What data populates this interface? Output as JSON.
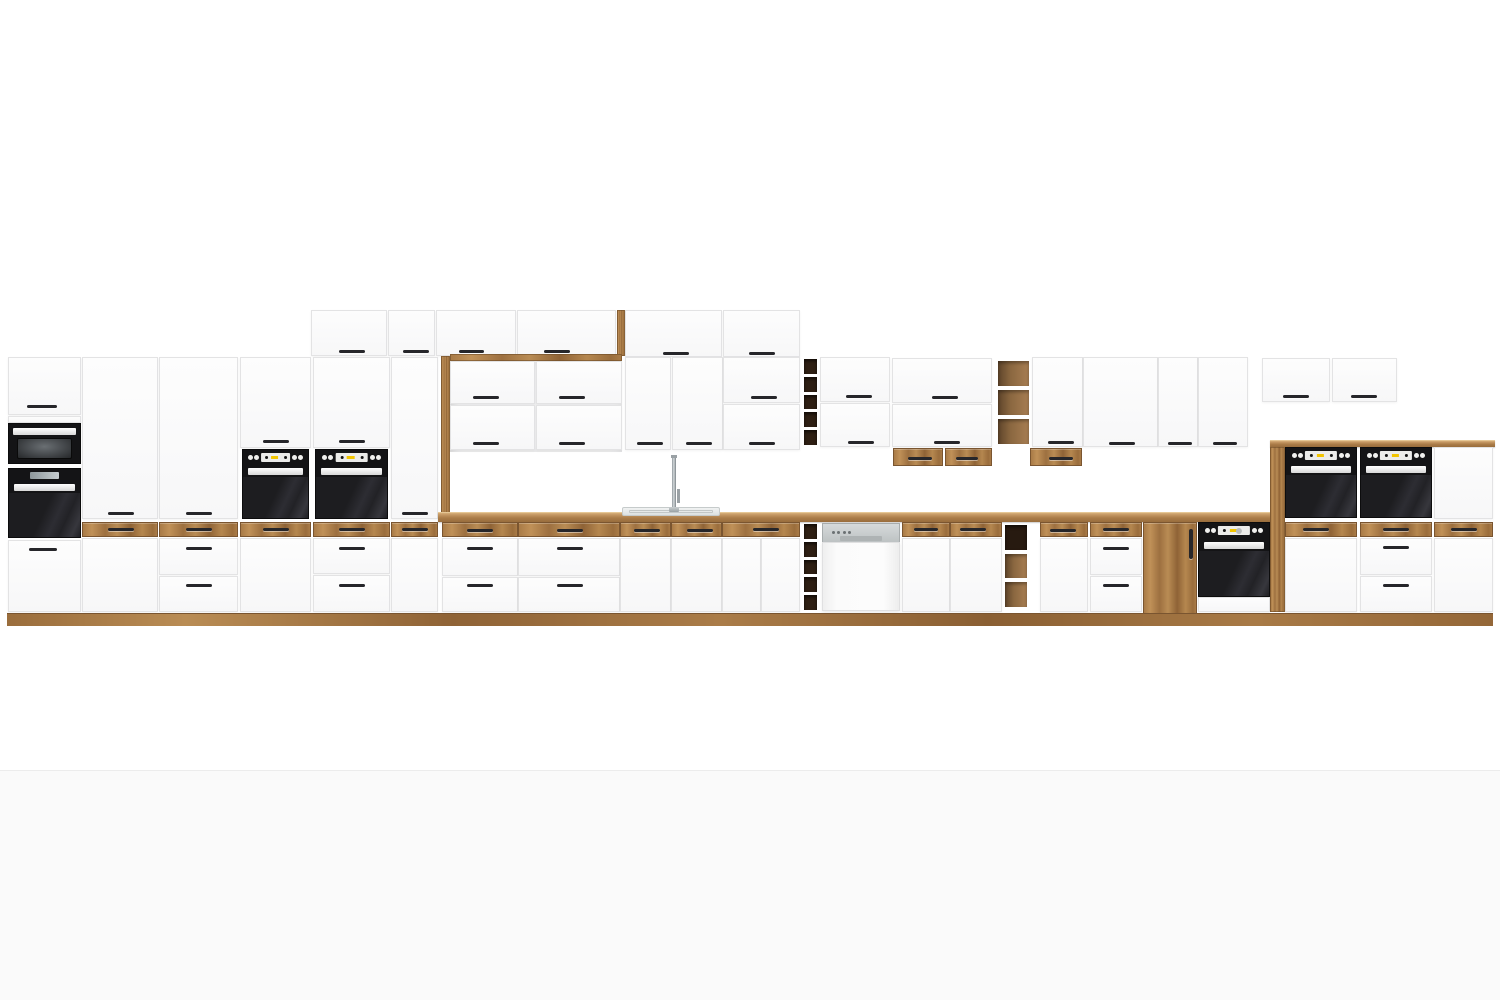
{
  "page": {
    "width": 1500,
    "height": 1000,
    "background": "#ffffff",
    "floor_band": {
      "y": 770,
      "color": "#fafafa",
      "divider_color": "#ececec"
    }
  },
  "palette": {
    "wood": "#ab7d49",
    "wood_light": "#c49a63",
    "wood_dark": "#8c6337",
    "counter_top": "#d6ae79",
    "front_white": "#fcfcfc",
    "front_edge": "#e3e3e4",
    "handle": "#26262a",
    "appliance_black": "#141416",
    "oven_door": "#26262a",
    "display_yellow": "#f2c500",
    "steel": "#c7cbcc",
    "cubby_dark": "#2e1f13",
    "shelf_wood": "#8a6740",
    "sink_steel": "#e7eaea"
  },
  "modules": [
    {
      "n": "recess-back-panel",
      "t": "recess",
      "x": 450,
      "y": 356,
      "w": 172,
      "h": 96
    },
    {
      "n": "wall-top-door-1",
      "t": "door",
      "x": 311,
      "y": 310,
      "w": 76,
      "h": 46,
      "hd": [
        [
          338,
          349,
          26
        ]
      ]
    },
    {
      "n": "wall-top-door-2",
      "t": "door",
      "x": 388,
      "y": 310,
      "w": 47,
      "h": 46,
      "hd": [
        [
          402,
          349,
          26
        ]
      ]
    },
    {
      "n": "wall-top-door-3",
      "t": "door",
      "x": 436,
      "y": 310,
      "w": 80,
      "h": 46,
      "hd": [
        [
          458,
          349,
          25
        ]
      ]
    },
    {
      "n": "wall-top-door-4",
      "t": "door",
      "x": 517,
      "y": 310,
      "w": 99,
      "h": 46,
      "hd": [
        [
          543,
          349,
          26
        ]
      ]
    },
    {
      "n": "wall-top-end-panel",
      "t": "woodstrip",
      "x": 617,
      "y": 310,
      "w": 8,
      "h": 46
    },
    {
      "n": "wall-top-door-5",
      "t": "door",
      "x": 625,
      "y": 310,
      "w": 97,
      "h": 47,
      "hd": [
        [
          662,
          351,
          26
        ]
      ]
    },
    {
      "n": "wall-top-door-6",
      "t": "door",
      "x": 723,
      "y": 310,
      "w": 77,
      "h": 47,
      "hd": [
        [
          748,
          351,
          26
        ]
      ]
    },
    {
      "n": "tall1-top-door",
      "t": "door",
      "x": 8,
      "y": 357,
      "w": 73,
      "h": 58,
      "hd": [
        [
          26,
          404,
          30
        ]
      ]
    },
    {
      "n": "tall1-filler",
      "t": "door",
      "x": 8,
      "y": 416,
      "w": 73,
      "h": 7
    },
    {
      "n": "tall1-microwave",
      "t": "micro",
      "x": 8,
      "y": 423,
      "w": 73,
      "h": 41
    },
    {
      "n": "tall1-compact-oven",
      "t": "compact",
      "x": 8,
      "y": 468,
      "w": 73,
      "h": 70
    },
    {
      "n": "tall1-drawer",
      "t": "door",
      "x": 8,
      "y": 540,
      "w": 73,
      "h": 72,
      "hd": [
        [
          28,
          547,
          28
        ]
      ]
    },
    {
      "n": "tall2-door-upper",
      "t": "door",
      "x": 82,
      "y": 357,
      "w": 76,
      "h": 162,
      "hd": [
        [
          107,
          511,
          26
        ]
      ]
    },
    {
      "n": "tall2-wood-drawer",
      "t": "woodfront",
      "x": 82,
      "y": 522,
      "w": 76,
      "h": 15,
      "hd": [
        [
          107,
          527,
          26
        ]
      ]
    },
    {
      "n": "tall2-door-lower",
      "t": "door",
      "x": 82,
      "y": 538,
      "w": 76,
      "h": 74
    },
    {
      "n": "tall3-door-upper",
      "t": "door",
      "x": 159,
      "y": 357,
      "w": 79,
      "h": 162,
      "hd": [
        [
          185,
          511,
          26
        ]
      ]
    },
    {
      "n": "tall3-wood-drawer",
      "t": "woodfront",
      "x": 159,
      "y": 522,
      "w": 79,
      "h": 15,
      "hd": [
        [
          185,
          527,
          26
        ]
      ]
    },
    {
      "n": "tall3-drawer-1",
      "t": "door",
      "x": 159,
      "y": 538,
      "w": 79,
      "h": 37,
      "hd": [
        [
          185,
          546,
          26
        ]
      ]
    },
    {
      "n": "tall3-drawer-2",
      "t": "door",
      "x": 159,
      "y": 576,
      "w": 79,
      "h": 36,
      "hd": [
        [
          185,
          583,
          26
        ]
      ]
    },
    {
      "n": "ovencol1-door",
      "t": "door",
      "x": 240,
      "y": 357,
      "w": 71,
      "h": 91,
      "hd": [
        [
          262,
          439,
          26
        ]
      ]
    },
    {
      "n": "ovencol1-oven",
      "t": "oven",
      "x": 242,
      "y": 449,
      "w": 67,
      "h": 70
    },
    {
      "n": "ovencol1-wood-drawer",
      "t": "woodfront",
      "x": 240,
      "y": 522,
      "w": 71,
      "h": 15,
      "hd": [
        [
          262,
          527,
          26
        ]
      ]
    },
    {
      "n": "ovencol1-door-lower",
      "t": "door",
      "x": 240,
      "y": 538,
      "w": 71,
      "h": 74
    },
    {
      "n": "ovencol2-door",
      "t": "door",
      "x": 313,
      "y": 357,
      "w": 77,
      "h": 91,
      "hd": [
        [
          338,
          439,
          26
        ]
      ]
    },
    {
      "n": "ovencol2-oven",
      "t": "oven",
      "x": 315,
      "y": 449,
      "w": 73,
      "h": 70
    },
    {
      "n": "ovencol2-wood-drawer",
      "t": "woodfront",
      "x": 313,
      "y": 522,
      "w": 77,
      "h": 15,
      "hd": [
        [
          338,
          527,
          26
        ]
      ]
    },
    {
      "n": "ovencol2-drawer-1",
      "t": "door",
      "x": 313,
      "y": 538,
      "w": 77,
      "h": 36,
      "hd": [
        [
          338,
          546,
          26
        ]
      ]
    },
    {
      "n": "ovencol2-drawer-2",
      "t": "door",
      "x": 313,
      "y": 575,
      "w": 77,
      "h": 37,
      "hd": [
        [
          338,
          583,
          26
        ]
      ]
    },
    {
      "n": "tall4-door",
      "t": "door",
      "x": 391,
      "y": 357,
      "w": 47,
      "h": 162,
      "hd": [
        [
          401,
          511,
          26
        ]
      ]
    },
    {
      "n": "tall4-wood-drawer",
      "t": "woodfront",
      "x": 391,
      "y": 522,
      "w": 47,
      "h": 15,
      "hd": [
        [
          401,
          527,
          26
        ]
      ]
    },
    {
      "n": "tall4-door-lower",
      "t": "door",
      "x": 391,
      "y": 538,
      "w": 47,
      "h": 74
    },
    {
      "n": "recess-frame-left",
      "t": "woodstrip",
      "x": 441,
      "y": 356,
      "w": 9,
      "h": 160
    },
    {
      "n": "recess-frame-top",
      "t": "woodstrip",
      "x": 450,
      "y": 354,
      "w": 172,
      "h": 7
    },
    {
      "n": "recess-flap-1",
      "t": "door",
      "x": 450,
      "y": 361,
      "w": 85,
      "h": 43,
      "hd": [
        [
          472,
          395,
          26
        ]
      ]
    },
    {
      "n": "recess-flap-2",
      "t": "door",
      "x": 536,
      "y": 361,
      "w": 86,
      "h": 43,
      "hd": [
        [
          558,
          395,
          26
        ]
      ]
    },
    {
      "n": "recess-flap-3",
      "t": "door",
      "x": 450,
      "y": 405,
      "w": 85,
      "h": 45,
      "hd": [
        [
          472,
          441,
          26
        ]
      ]
    },
    {
      "n": "recess-flap-4",
      "t": "door",
      "x": 536,
      "y": 405,
      "w": 86,
      "h": 45,
      "hd": [
        [
          558,
          441,
          26
        ]
      ]
    },
    {
      "n": "wall-door-1",
      "t": "door",
      "x": 625,
      "y": 357,
      "w": 46,
      "h": 93,
      "hd": [
        [
          636,
          441,
          26
        ]
      ]
    },
    {
      "n": "wall-door-2",
      "t": "door",
      "x": 672,
      "y": 357,
      "w": 51,
      "h": 93,
      "hd": [
        [
          685,
          441,
          26
        ]
      ]
    },
    {
      "n": "wall-flap-1",
      "t": "door",
      "x": 723,
      "y": 357,
      "w": 77,
      "h": 46,
      "hd": [
        [
          750,
          395,
          26
        ]
      ]
    },
    {
      "n": "wall-flap-2",
      "t": "door",
      "x": 723,
      "y": 404,
      "w": 77,
      "h": 46,
      "hd": [
        [
          748,
          441,
          26
        ]
      ]
    },
    {
      "n": "wall-wine-rack",
      "t": "wine",
      "x": 802,
      "y": 357,
      "w": 17,
      "h": 90,
      "cells": 5
    },
    {
      "n": "wall-flap-3",
      "t": "door",
      "x": 820,
      "y": 357,
      "w": 70,
      "h": 45,
      "hd": [
        [
          845,
          394,
          26
        ]
      ]
    },
    {
      "n": "wall-flap-4",
      "t": "door",
      "x": 820,
      "y": 403,
      "w": 70,
      "h": 44,
      "hd": [
        [
          847,
          440,
          26
        ]
      ]
    },
    {
      "n": "wall-flap-5",
      "t": "door",
      "x": 892,
      "y": 358,
      "w": 100,
      "h": 45,
      "hd": [
        [
          931,
          395,
          26
        ]
      ]
    },
    {
      "n": "wall-flap-6",
      "t": "door",
      "x": 892,
      "y": 404,
      "w": 100,
      "h": 43,
      "hd": [
        [
          933,
          440,
          26
        ]
      ]
    },
    {
      "n": "wall-wood-drawer-1",
      "t": "woodfront",
      "x": 893,
      "y": 448,
      "w": 50,
      "h": 18,
      "hd": [
        [
          907,
          456,
          24
        ]
      ]
    },
    {
      "n": "wall-wood-drawer-2",
      "t": "woodfront",
      "x": 945,
      "y": 448,
      "w": 47,
      "h": 18,
      "hd": [
        [
          955,
          456,
          22
        ]
      ]
    },
    {
      "n": "wall-open-shelf",
      "t": "shelf",
      "x": 995,
      "y": 358,
      "w": 37,
      "h": 89,
      "cells": [
        "mid",
        "mid",
        "mid"
      ]
    },
    {
      "n": "wall-door-3",
      "t": "door",
      "x": 1032,
      "y": 357,
      "w": 51,
      "h": 90,
      "hd": [
        [
          1047,
          440,
          26
        ]
      ]
    },
    {
      "n": "wall-wood-drawer-3",
      "t": "woodfront",
      "x": 1030,
      "y": 448,
      "w": 52,
      "h": 18,
      "hd": [
        [
          1048,
          456,
          24
        ]
      ]
    },
    {
      "n": "wall-door-4",
      "t": "door",
      "x": 1083,
      "y": 357,
      "w": 75,
      "h": 90,
      "hd": [
        [
          1108,
          441,
          26
        ]
      ]
    },
    {
      "n": "wall-door-5",
      "t": "door",
      "x": 1158,
      "y": 357,
      "w": 40,
      "h": 90,
      "hd": [
        [
          1167,
          441,
          24
        ]
      ]
    },
    {
      "n": "wall-door-6",
      "t": "door",
      "x": 1198,
      "y": 357,
      "w": 50,
      "h": 90,
      "hd": [
        [
          1212,
          441,
          24
        ]
      ]
    },
    {
      "n": "overoven-flap-1",
      "t": "door",
      "x": 1262,
      "y": 358,
      "w": 68,
      "h": 44,
      "hd": [
        [
          1282,
          394,
          26
        ]
      ]
    },
    {
      "n": "overoven-flap-2",
      "t": "door",
      "x": 1332,
      "y": 358,
      "w": 65,
      "h": 44,
      "hd": [
        [
          1350,
          394,
          26
        ]
      ]
    },
    {
      "n": "countertop",
      "t": "counter",
      "x": 438,
      "y": 512,
      "w": 832,
      "h": 10
    },
    {
      "n": "sink-basin",
      "t": "sink",
      "x": 622,
      "y": 507,
      "w": 98,
      "h": 9
    },
    {
      "n": "faucet",
      "t": "faucet",
      "x": 668,
      "y": 455,
      "w": 18,
      "h": 57
    },
    {
      "n": "base1-wood-drawer",
      "t": "woodfront",
      "x": 442,
      "y": 522,
      "w": 76,
      "h": 15,
      "hd": [
        [
          466,
          528,
          26
        ]
      ]
    },
    {
      "n": "base1-drawer-1",
      "t": "door",
      "x": 442,
      "y": 538,
      "w": 76,
      "h": 38,
      "hd": [
        [
          466,
          546,
          26
        ]
      ]
    },
    {
      "n": "base1-drawer-2",
      "t": "door",
      "x": 442,
      "y": 577,
      "w": 76,
      "h": 35,
      "hd": [
        [
          466,
          583,
          26
        ]
      ]
    },
    {
      "n": "base2-wood-drawer",
      "t": "woodfront",
      "x": 518,
      "y": 522,
      "w": 102,
      "h": 15,
      "hd": [
        [
          556,
          528,
          26
        ]
      ]
    },
    {
      "n": "base2-drawer-1",
      "t": "door",
      "x": 518,
      "y": 538,
      "w": 102,
      "h": 38,
      "hd": [
        [
          556,
          546,
          26
        ]
      ]
    },
    {
      "n": "base2-drawer-2",
      "t": "door",
      "x": 518,
      "y": 577,
      "w": 102,
      "h": 35,
      "hd": [
        [
          556,
          583,
          26
        ]
      ]
    },
    {
      "n": "sinkbase-wood-drawer-1",
      "t": "woodfront",
      "x": 620,
      "y": 522,
      "w": 51,
      "h": 15,
      "hd": [
        [
          633,
          528,
          26
        ]
      ]
    },
    {
      "n": "sinkbase-wood-drawer-2",
      "t": "woodfront",
      "x": 671,
      "y": 522,
      "w": 51,
      "h": 15,
      "hd": [
        [
          686,
          528,
          26
        ]
      ]
    },
    {
      "n": "sinkbase-door-1",
      "t": "door",
      "x": 620,
      "y": 538,
      "w": 51,
      "h": 74
    },
    {
      "n": "sinkbase-door-2",
      "t": "door",
      "x": 671,
      "y": 538,
      "w": 51,
      "h": 74
    },
    {
      "n": "base3-wood-drawer",
      "t": "woodfront",
      "x": 722,
      "y": 522,
      "w": 78,
      "h": 15,
      "hd": [
        [
          752,
          527,
          26
        ]
      ]
    },
    {
      "n": "base3-door-1",
      "t": "door",
      "x": 722,
      "y": 538,
      "w": 39,
      "h": 74
    },
    {
      "n": "base3-door-2",
      "t": "door",
      "x": 761,
      "y": 538,
      "w": 39,
      "h": 74
    },
    {
      "n": "base-wine-rack",
      "t": "wine",
      "x": 802,
      "y": 522,
      "w": 17,
      "h": 90,
      "cells": 5
    },
    {
      "n": "dishwasher",
      "t": "dw",
      "x": 822,
      "y": 523,
      "w": 78,
      "h": 88
    },
    {
      "n": "base4-wood-drawer",
      "t": "woodfront",
      "x": 902,
      "y": 522,
      "w": 48,
      "h": 15,
      "hd": [
        [
          913,
          527,
          24
        ]
      ]
    },
    {
      "n": "base4-door",
      "t": "door",
      "x": 902,
      "y": 538,
      "w": 48,
      "h": 74
    },
    {
      "n": "base5-wood-drawer",
      "t": "woodfront",
      "x": 950,
      "y": 522,
      "w": 52,
      "h": 15,
      "hd": [
        [
          959,
          527,
          26
        ]
      ]
    },
    {
      "n": "base5-door",
      "t": "door",
      "x": 950,
      "y": 538,
      "w": 52,
      "h": 74
    },
    {
      "n": "base-open-shelf",
      "t": "shelf",
      "x": 1002,
      "y": 522,
      "w": 28,
      "h": 88,
      "cells": [
        "dark",
        "mid",
        "mid"
      ]
    },
    {
      "n": "base6-wood-drawer",
      "t": "woodfront",
      "x": 1040,
      "y": 522,
      "w": 48,
      "h": 15,
      "hd": [
        [
          1049,
          528,
          26
        ]
      ]
    },
    {
      "n": "base6-door",
      "t": "door",
      "x": 1040,
      "y": 538,
      "w": 48,
      "h": 74
    },
    {
      "n": "base7-wood-drawer",
      "t": "woodfront",
      "x": 1090,
      "y": 522,
      "w": 52,
      "h": 15,
      "hd": [
        [
          1102,
          527,
          26
        ]
      ]
    },
    {
      "n": "base7-drawer-1",
      "t": "door",
      "x": 1090,
      "y": 538,
      "w": 52,
      "h": 37,
      "hd": [
        [
          1102,
          546,
          26
        ]
      ]
    },
    {
      "n": "base7-drawer-2",
      "t": "door",
      "x": 1090,
      "y": 576,
      "w": 52,
      "h": 36,
      "hd": [
        [
          1102,
          583,
          26
        ]
      ]
    },
    {
      "n": "base-wood-door",
      "t": "woodfront",
      "x": 1143,
      "y": 522,
      "w": 54,
      "h": 95,
      "hv": [
        1188,
        528,
        30
      ]
    },
    {
      "n": "base-oven",
      "t": "baseoven",
      "x": 1198,
      "y": 522,
      "w": 72,
      "h": 75
    },
    {
      "n": "base-oven-bottom-panel",
      "t": "door",
      "x": 1198,
      "y": 597,
      "w": 72,
      "h": 15
    },
    {
      "n": "housing-countertop",
      "t": "counter",
      "x": 1270,
      "y": 440,
      "w": 225,
      "h": 7
    },
    {
      "n": "housing-left-panel",
      "t": "woodstrip",
      "x": 1270,
      "y": 447,
      "w": 15,
      "h": 165
    },
    {
      "n": "housing-oven-1",
      "t": "oven",
      "x": 1285,
      "y": 447,
      "w": 72,
      "h": 71
    },
    {
      "n": "housing-oven-2",
      "t": "oven",
      "x": 1360,
      "y": 447,
      "w": 72,
      "h": 71
    },
    {
      "n": "housing-upper-panel",
      "t": "door",
      "x": 1434,
      "y": 447,
      "w": 59,
      "h": 72
    },
    {
      "n": "housing-wood-drawer-1",
      "t": "woodfront",
      "x": 1285,
      "y": 522,
      "w": 72,
      "h": 15,
      "hd": [
        [
          1302,
          527,
          26
        ]
      ]
    },
    {
      "n": "housing-wood-drawer-2",
      "t": "woodfront",
      "x": 1360,
      "y": 522,
      "w": 72,
      "h": 15,
      "hd": [
        [
          1382,
          527,
          26
        ]
      ]
    },
    {
      "n": "housing-wood-drawer-3",
      "t": "woodfront",
      "x": 1434,
      "y": 522,
      "w": 59,
      "h": 15,
      "hd": [
        [
          1450,
          527,
          26
        ]
      ]
    },
    {
      "n": "housing-door-1",
      "t": "door",
      "x": 1285,
      "y": 538,
      "w": 72,
      "h": 74
    },
    {
      "n": "housing-drawer-1",
      "t": "door",
      "x": 1360,
      "y": 538,
      "w": 72,
      "h": 37,
      "hd": [
        [
          1382,
          545,
          26
        ]
      ]
    },
    {
      "n": "housing-drawer-2",
      "t": "door",
      "x": 1360,
      "y": 576,
      "w": 72,
      "h": 36,
      "hd": [
        [
          1382,
          583,
          26
        ]
      ]
    },
    {
      "n": "housing-door-2",
      "t": "door",
      "x": 1434,
      "y": 538,
      "w": 59,
      "h": 74
    },
    {
      "n": "plinth",
      "t": "plinth",
      "x": 7,
      "y": 613,
      "w": 1486,
      "h": 13
    }
  ]
}
